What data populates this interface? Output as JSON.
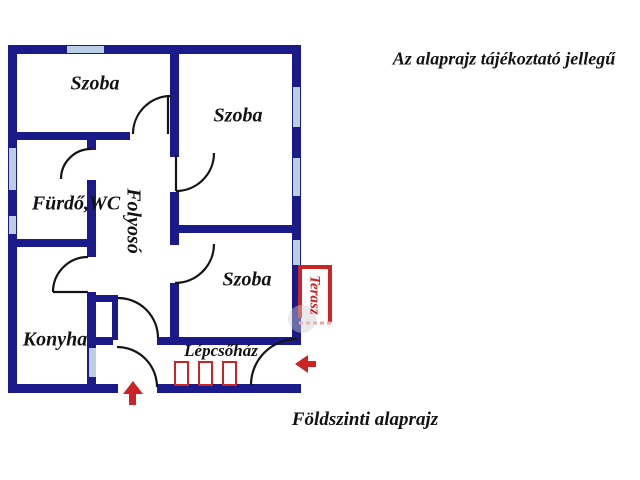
{
  "titles": {
    "disclaimer": "Az alaprajz tájékoztató jellegű",
    "caption": "Földszinti alaprajz"
  },
  "rooms": {
    "szoba_top_left": "Szoba",
    "szoba_top_right": "Szoba",
    "szoba_middle": "Szoba",
    "furdo_wc": "Fürdő,WC",
    "folyoso": "Folyosó",
    "konyha": "Konyha",
    "lepcsohaz": "Lépcsőház",
    "terasz": "Terasz"
  },
  "colors": {
    "wall": "#1a1a8a",
    "window": "#b9cfe6",
    "door_arc": "#141414",
    "accent_red": "#cc2424",
    "background": "#ffffff"
  },
  "icons": {
    "stairs": "stairs-icon",
    "entry_arrow_up": "arrow-up-icon",
    "entry_arrow_left": "arrow-left-icon"
  }
}
